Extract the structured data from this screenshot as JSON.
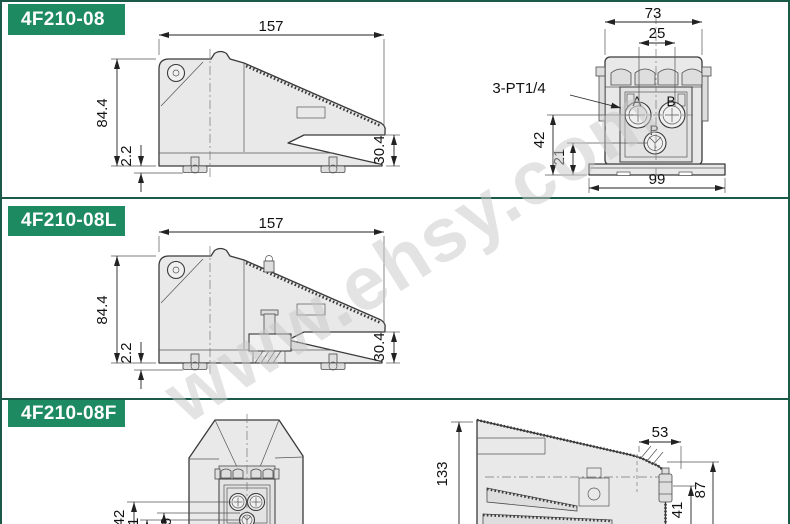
{
  "page": {
    "watermark": "www.ehsy.com",
    "colors": {
      "header_bg": "#1e8a62",
      "frame": "#1b5a49",
      "drawing_fill": "#e9e9e9"
    }
  },
  "sections": [
    {
      "title": "4F210-08",
      "side": {
        "width": "157",
        "height": "84.4",
        "base_gap": "2.2",
        "pedal_height": "30.4"
      },
      "front": {
        "top_width": "73",
        "port_pitch": "25",
        "thread_note": "3-PT1/4",
        "port_a": "A",
        "port_b": "B",
        "port_p": "P",
        "port_height": "42",
        "p_port_height": "21",
        "base_width": "99"
      }
    },
    {
      "title": "4F210-08L",
      "side": {
        "width": "157",
        "height": "84.4",
        "base_gap": "2.2",
        "pedal_height": "30.4"
      }
    },
    {
      "title": "4F210-08F",
      "front": {
        "port_height": "42",
        "p_port_height": "21",
        "offset": "6"
      },
      "side": {
        "height": "133",
        "top_width": "53",
        "guard_height": "87",
        "inner_height": "41"
      }
    }
  ]
}
